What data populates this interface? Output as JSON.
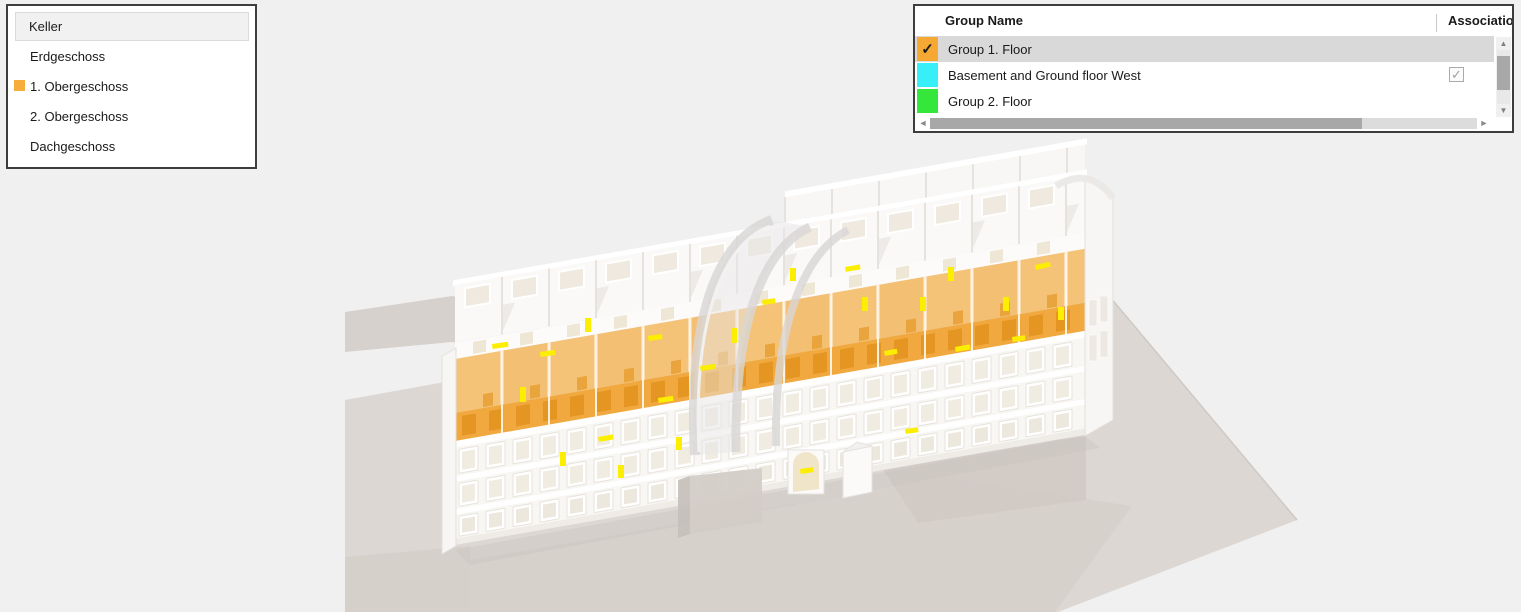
{
  "app": {
    "background": "#F0F0F0"
  },
  "icons": {
    "check": "✓",
    "left_arrow": "◄",
    "right_arrow": "►",
    "up_arrow": "▲",
    "down_arrow": "▼"
  },
  "floors_panel": {
    "items": [
      {
        "label": "Keller",
        "selected": true
      },
      {
        "label": "Erdgeschoss",
        "selected": false
      },
      {
        "label": "1. Obergeschoss",
        "selected": false,
        "swatch_color": "#F6AD3B"
      },
      {
        "label": "2. Obergeschoss",
        "selected": false
      },
      {
        "label": "Dachgeschoss",
        "selected": false
      }
    ]
  },
  "groups_panel": {
    "columns": {
      "name": "Group Name",
      "association": "Association"
    },
    "rows": [
      {
        "name": "Group 1. Floor",
        "color": "#F5A833",
        "swatch_checked": true,
        "selected": true,
        "association_checked": false
      },
      {
        "name": "Basement and Ground floor West",
        "color": "#38EFF8",
        "swatch_checked": false,
        "selected": false,
        "association_checked": true
      },
      {
        "name": "Group 2. Floor",
        "color": "#35E73A",
        "swatch_checked": false,
        "selected": false,
        "association_checked": false
      }
    ]
  },
  "viewport": {
    "highlighted_floor": "1. Obergeschoss",
    "colors": {
      "ground": "#DCD7D3",
      "floor_highlight": "#F1A93F",
      "floor_highlight_light": "#F5C377",
      "light_fixture": "#FBEE00"
    },
    "lights": [
      [
        492,
        344,
        16,
        5,
        -8
      ],
      [
        520,
        387,
        6,
        15,
        0
      ],
      [
        560,
        452,
        6,
        14,
        0
      ],
      [
        598,
        437,
        15,
        5,
        -10
      ],
      [
        648,
        336,
        14,
        5,
        -8
      ],
      [
        658,
        398,
        15,
        5,
        -8
      ],
      [
        676,
        437,
        6,
        13,
        0
      ],
      [
        700,
        366,
        15,
        5,
        -8
      ],
      [
        731,
        328,
        6,
        15,
        0
      ],
      [
        762,
        300,
        13,
        5,
        -8
      ],
      [
        790,
        268,
        6,
        13,
        0
      ],
      [
        845,
        267,
        15,
        5,
        -10
      ],
      [
        862,
        297,
        6,
        14,
        0
      ],
      [
        884,
        351,
        13,
        5,
        -10
      ],
      [
        905,
        429,
        13,
        5,
        -8
      ],
      [
        920,
        297,
        6,
        14,
        0
      ],
      [
        948,
        267,
        6,
        14,
        0
      ],
      [
        955,
        347,
        15,
        5,
        -10
      ],
      [
        1003,
        297,
        6,
        14,
        0
      ],
      [
        1012,
        337,
        13,
        5,
        -8
      ],
      [
        1035,
        265,
        15,
        5,
        -12
      ],
      [
        1058,
        307,
        6,
        13,
        0
      ],
      [
        618,
        465,
        6,
        13,
        0
      ],
      [
        800,
        469,
        13,
        5,
        -8
      ],
      [
        540,
        352,
        15,
        5,
        -8
      ],
      [
        585,
        318,
        6,
        14,
        0
      ]
    ]
  }
}
